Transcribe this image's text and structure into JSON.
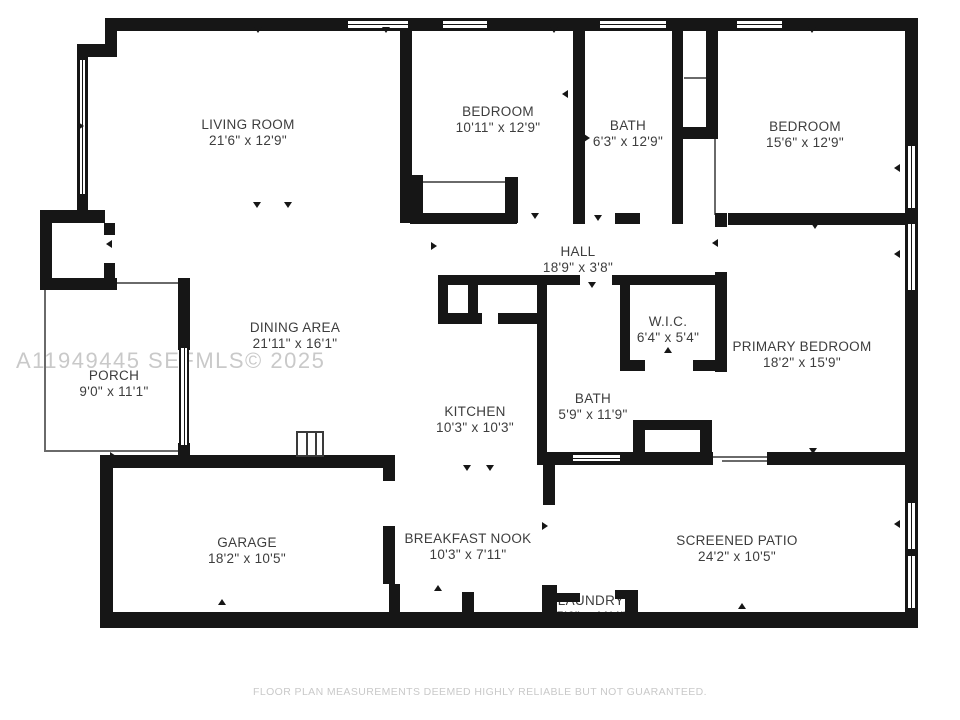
{
  "plan": {
    "watermark": "A11949445  SEFMLS© 2025",
    "footer": "FLOOR PLAN MEASUREMENTS DEEMED HIGHLY RELIABLE BUT NOT GUARANTEED.",
    "wall_color": "#161616",
    "label_color": "#3d3d3d",
    "watermark_color": "#c9c9c9",
    "rooms": [
      {
        "id": "living-room",
        "name": "LIVING ROOM",
        "dims": "21'6\" x 12'9\""
      },
      {
        "id": "bedroom-2",
        "name": "BEDROOM",
        "dims": "10'11\" x 12'9\""
      },
      {
        "id": "bath-1",
        "name": "BATH",
        "dims": "6'3\" x 12'9\""
      },
      {
        "id": "bedroom-3",
        "name": "BEDROOM",
        "dims": "15'6\" x 12'9\""
      },
      {
        "id": "hall",
        "name": "HALL",
        "dims": "18'9\" x 3'8\""
      },
      {
        "id": "dining-area",
        "name": "DINING AREA",
        "dims": "21'11\" x 16'1\""
      },
      {
        "id": "wic",
        "name": "W.I.C.",
        "dims": "6'4\" x 5'4\""
      },
      {
        "id": "primary-bedroom",
        "name": "PRIMARY BEDROOM",
        "dims": "18'2\" x 15'9\""
      },
      {
        "id": "porch",
        "name": "PORCH",
        "dims": "9'0\" x 11'1\""
      },
      {
        "id": "bath-2",
        "name": "BATH",
        "dims": "5'9\" x 11'9\""
      },
      {
        "id": "kitchen",
        "name": "KITCHEN",
        "dims": "10'3\" x 10'3\""
      },
      {
        "id": "garage",
        "name": "GARAGE",
        "dims": "18'2\" x 10'5\""
      },
      {
        "id": "breakfast-nook",
        "name": "BREAKFAST NOOK",
        "dims": "10'3\" x 7'11\""
      },
      {
        "id": "laundry",
        "name": "LAUNDRY",
        "dims": "5'6\" x 11'4\""
      },
      {
        "id": "screened-patio",
        "name": "SCREENED PATIO",
        "dims": "24'2\" x 10'5\""
      }
    ]
  }
}
